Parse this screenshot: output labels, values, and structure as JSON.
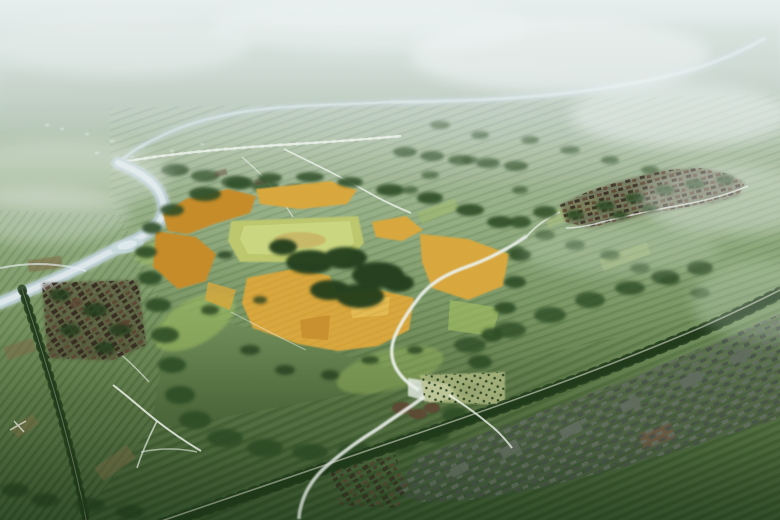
{
  "scene": {
    "type": "aerial-landscape-rendering",
    "subject": "misty bird's-eye rendering of a river plain with a central heritage site of golden paddy fields, a raised platform, tree belts, villages and tree-lined roads"
  },
  "palette": {
    "sky_top": "#cfdcdd",
    "haze_mid": "#b7c7bd",
    "haze_green": "#a3b89a",
    "plain_green": "#8aa578",
    "mid_green": "#6f8d5a",
    "deep_green": "#4f6a3c",
    "dark_green": "#32502b",
    "hill_far": "#a9bcab",
    "fog_white": "#eef4f3",
    "vignette": "#142a0e",
    "river_water": "#b9cdd4",
    "river_highlight": "#e7eff1",
    "pond_blue": "#c6d8dc",
    "path_white": "#eef3ec",
    "stream_white": "#e9efe9",
    "stripe_light": "#dcebc0",
    "stripe_dark": "#1c3a12",
    "field_light": "#b5c87e",
    "meadow_light": "#a3bf63",
    "golden": "#d8a73c",
    "golden_light": "#e6c158",
    "golden_deep": "#c68c2c",
    "platform": "#bcc76e",
    "platform_light": "#ced984",
    "platform_mound": "#c7ae5e",
    "forest_dark": "#223d1b",
    "tree_green": "#2f4e27",
    "village_base": "#4a3b2c",
    "village_dark": "#382c22",
    "village_red": "#5f4634",
    "village_grey": "#626d60",
    "village_grey_dark": "#49524a",
    "road_dark": "#1d3016",
    "road_line": "#97a48c",
    "soil_brown": "#7e6b47",
    "soil_red": "#8a5a40",
    "orchard_ground": "#b9c18a"
  }
}
